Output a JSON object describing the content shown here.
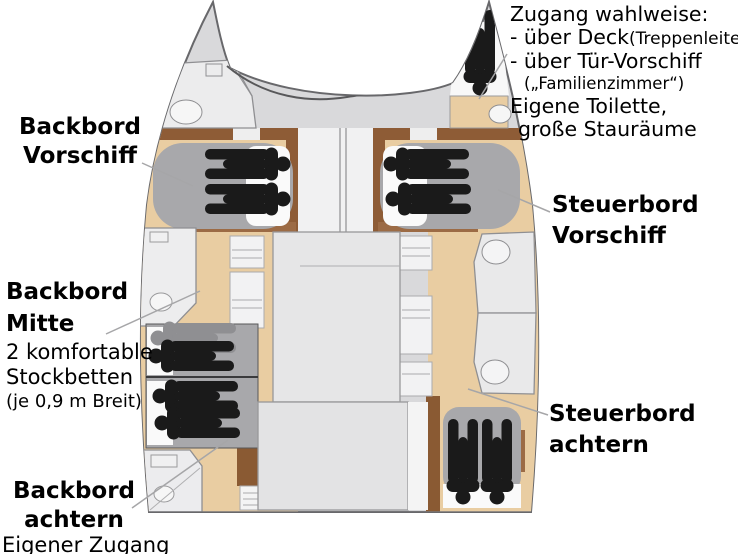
{
  "diagram_title": "Katamaran Kabinen-Grundriss (Deckplan)",
  "labels": {
    "port_fore": {
      "line1": "Backbord",
      "line2": "Vorschiff"
    },
    "starboard_fore": {
      "line1": "Steuerbord",
      "line2": "Vorschiff"
    },
    "port_mid": {
      "line1": "Backbord",
      "line2": "Mitte",
      "note1": "2 komfortable",
      "note2": "Stockbetten",
      "note3": "(je 0,9 m Breit)"
    },
    "port_aft": {
      "line1": "Backbord",
      "line2": "achtern",
      "note": "Eigener Zugang"
    },
    "starboard_aft": {
      "line1": "Steuerbord",
      "line2": "achtern"
    },
    "access_note": {
      "title": "Zugang wahlweise:",
      "bullet1": "- über Deck",
      "bullet1_detail": "(Treppenleiter)",
      "bullet2": "- über Tür-Vorschiff",
      "bullet2_detail": "(„Familienzimmer“)",
      "feature1": "Eigene Toilette,",
      "feature2": "große Stauräume"
    }
  },
  "icons": {
    "person_black": "person-icon (berth occupant)",
    "person_gray": "person-icon (upper bunk occupant)",
    "toilet": "toilet-icon"
  },
  "colors": {
    "background": "#ffffff",
    "hull_gray": "#d9d9db",
    "wood": "#e9cda2",
    "wood_dark": "#8e5c36",
    "bed_gray": "#a8a8ab",
    "bed_white": "#fafafa",
    "room_gray": "#ececed",
    "saloon_gray": "#e6e6e7",
    "figure_black": "#1a1a1a",
    "figure_gray": "#8f8f92",
    "outline": "#68686b",
    "leader_line": "#a6a6a8",
    "text": "#000000"
  }
}
